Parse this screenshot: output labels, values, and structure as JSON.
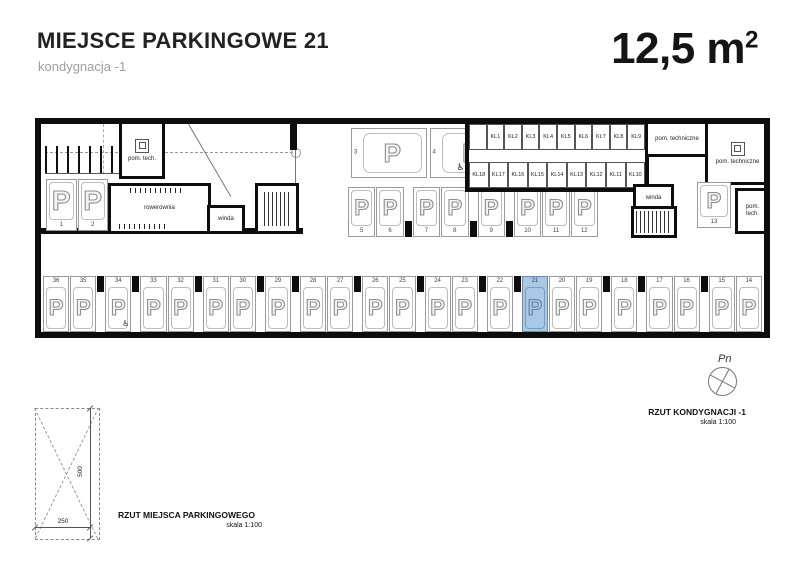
{
  "header": {
    "title": "MIEJSCE PARKINGOWE 21",
    "subtitle": "kondygnacja -1",
    "area_value": "12,5 m",
    "area_sup": "2"
  },
  "plan": {
    "p_symbol": "P",
    "wheelchair_icon": "♿",
    "highlight_color": "#a9c7e6",
    "rooms": {
      "pom_tech_left": "pom. tech.",
      "rowerownia": "rowerownia",
      "winda_left": "winda",
      "pom_techniczne_small": "pom. techniczne",
      "pom_techniczne_large": "pom. techniczne",
      "winda_right": "winda",
      "pom_tech_right": "pom. tech."
    },
    "left_spots": [
      {
        "n": "1"
      },
      {
        "n": "2"
      }
    ],
    "horizontal_spots": [
      {
        "n": "3"
      },
      {
        "n": "4",
        "wheelchair": true
      }
    ],
    "upper_row": [
      {
        "n": "5"
      },
      {
        "n": "6"
      },
      {
        "pillar": true
      },
      {
        "n": "7"
      },
      {
        "n": "8"
      },
      {
        "pillar": true
      },
      {
        "n": "9"
      },
      {
        "pillar": true
      },
      {
        "n": "10"
      },
      {
        "n": "11"
      },
      {
        "n": "12"
      }
    ],
    "spot_13": {
      "n": "13"
    },
    "lockers_top": [
      "KL1",
      "KL2",
      "KL3",
      "KL4",
      "KL5",
      "KL6",
      "KL7",
      "KL8",
      "KL9"
    ],
    "lockers_bottom": [
      "KL18",
      "KL17",
      "KL16",
      "KL15",
      "KL14",
      "KL13",
      "KL12",
      "KL11",
      "KL10"
    ],
    "lower_row": [
      {
        "n": "36"
      },
      {
        "n": "35"
      },
      {
        "pillar": true
      },
      {
        "n": "34",
        "wheelchair": true
      },
      {
        "pillar": true
      },
      {
        "n": "33"
      },
      {
        "n": "32"
      },
      {
        "pillar": true
      },
      {
        "n": "31"
      },
      {
        "n": "30"
      },
      {
        "pillar": true
      },
      {
        "n": "29"
      },
      {
        "pillar": true
      },
      {
        "n": "28"
      },
      {
        "n": "27"
      },
      {
        "pillar": true
      },
      {
        "n": "26"
      },
      {
        "n": "25"
      },
      {
        "pillar": true
      },
      {
        "n": "24"
      },
      {
        "n": "23"
      },
      {
        "pillar": true
      },
      {
        "n": "22"
      },
      {
        "pillar": true
      },
      {
        "n": "21",
        "highlight": true
      },
      {
        "n": "20"
      },
      {
        "n": "19"
      },
      {
        "pillar": true
      },
      {
        "n": "18"
      },
      {
        "pillar": true
      },
      {
        "n": "17"
      },
      {
        "n": "16"
      },
      {
        "pillar": true
      },
      {
        "n": "15"
      },
      {
        "n": "14"
      }
    ]
  },
  "detail": {
    "height_label": "500",
    "width_label": "250",
    "caption": "RZUT MIEJSCA PARKINGOWEGO",
    "scale": "skala 1:100"
  },
  "compass": {
    "north_label": "Pn",
    "caption": "RZUT KONDYGNACJI -1",
    "scale": "skala 1:100"
  }
}
